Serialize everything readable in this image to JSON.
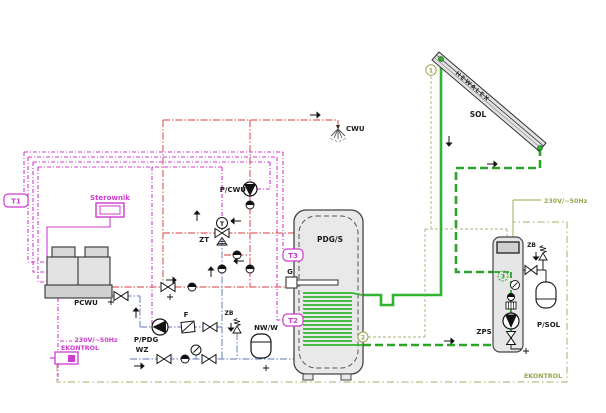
{
  "labels": {
    "t1": "T1",
    "controller": "Sterownik",
    "heat_pump": "PCWU",
    "dhw_pump": "P/CWU",
    "tap": "CWU",
    "mixing_valve": "ZT",
    "mixing_valve_sensor": "T",
    "tank": "PDG/S",
    "heater": "G",
    "sensor_top": "T3",
    "sensor_bottom": "T2",
    "charge_pump": "P/PDG",
    "filter": "F",
    "feed_water": "WZ",
    "safety_left": "ZB",
    "expansion_left": "NW/W",
    "power_left": "230V/~50Hz",
    "ekontrol_left": "EKONTROL",
    "collector": "SOL",
    "brand": "HEWALEX",
    "power_right": "230V/~50Hz",
    "ekontrol_right": "EKONTROL",
    "solar_station": "ZPS",
    "solar_pump": "P/SOL",
    "safety_right": "ZB",
    "sensor1": "1",
    "sensor2": "2",
    "sensor3": "3"
  },
  "colors": {
    "control_wire_magenta": "#cf3ccf",
    "hot_water_red": "#e06464",
    "cold_water_blue": "#8092c8",
    "solar_supply_green": "#2fb52f",
    "solar_return_green": "#2aa42a",
    "electric_olive": "#9aa34f",
    "component_black": "#1c1c1c"
  }
}
